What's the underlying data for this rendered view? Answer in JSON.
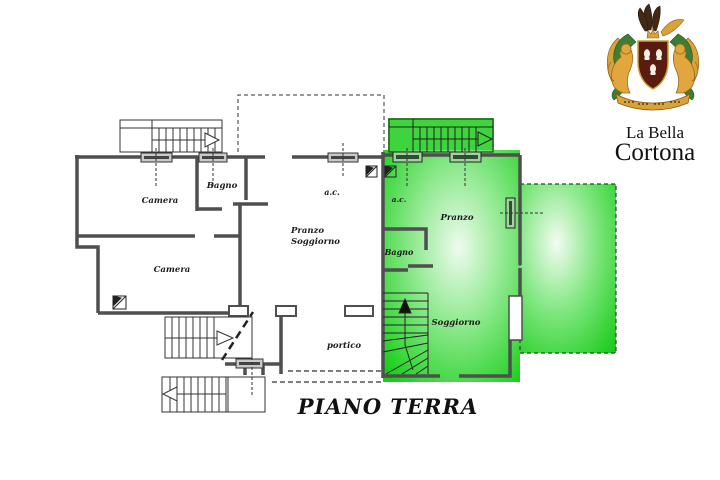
{
  "branding": {
    "name_line1": "La Bella",
    "name_line2": "Cortona"
  },
  "plan": {
    "title": "PIANO TERRA",
    "labels": {
      "camera1": "Camera",
      "bagno1": "Bagno",
      "camera2": "Camera",
      "pranzo_soggiorno_line1": "Pranzo",
      "pranzo_soggiorno_line2": "Soggiorno",
      "ac_left": "a.c.",
      "portico": "portico",
      "ac_green": "a.c.",
      "pranzo_green": "Pranzo",
      "bagno_green": "Bagno",
      "soggiorno_green": "Soggiorno"
    },
    "colors": {
      "wall": "#4f4f4f",
      "thin_line": "#333333",
      "highlight_edge": "#17cd17",
      "highlight_mid": "#63e263",
      "highlight_center": "#eefbee",
      "terrace_dash": "#14531a",
      "shield": "#5a1c0e",
      "lion_gold": "#e2a63e",
      "mantle_green": "#3e7d33",
      "banner_gold": "#d9a33a"
    }
  }
}
